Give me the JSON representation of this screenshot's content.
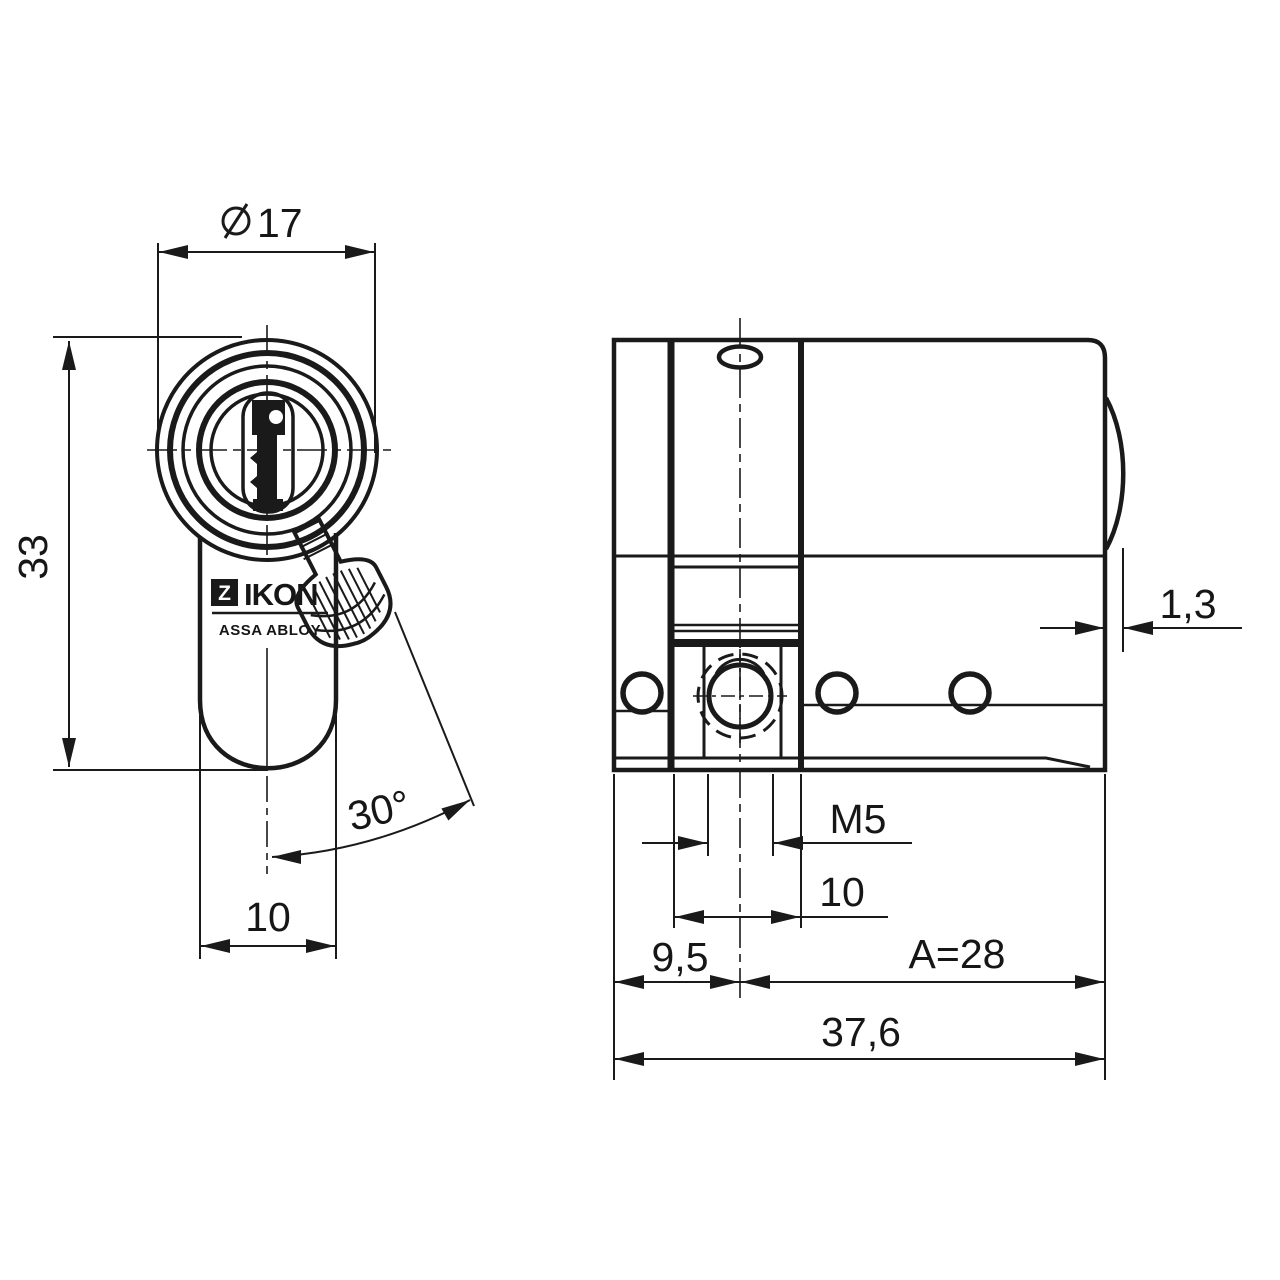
{
  "drawing_title": "IKON profile half cylinder technical drawing",
  "front_view": {
    "diameter": "17",
    "height": "33",
    "body_width": "10",
    "key_angle": "30°",
    "logo": {
      "prefix": "Z",
      "name": "IKON",
      "subtitle": "ASSA ABLOY"
    }
  },
  "side_view": {
    "cam_clearance": "1,3",
    "thread": "M5",
    "slot_width": "10",
    "fixing_offset": "9,5",
    "length_a": "A=28",
    "total_length": "37,6"
  }
}
